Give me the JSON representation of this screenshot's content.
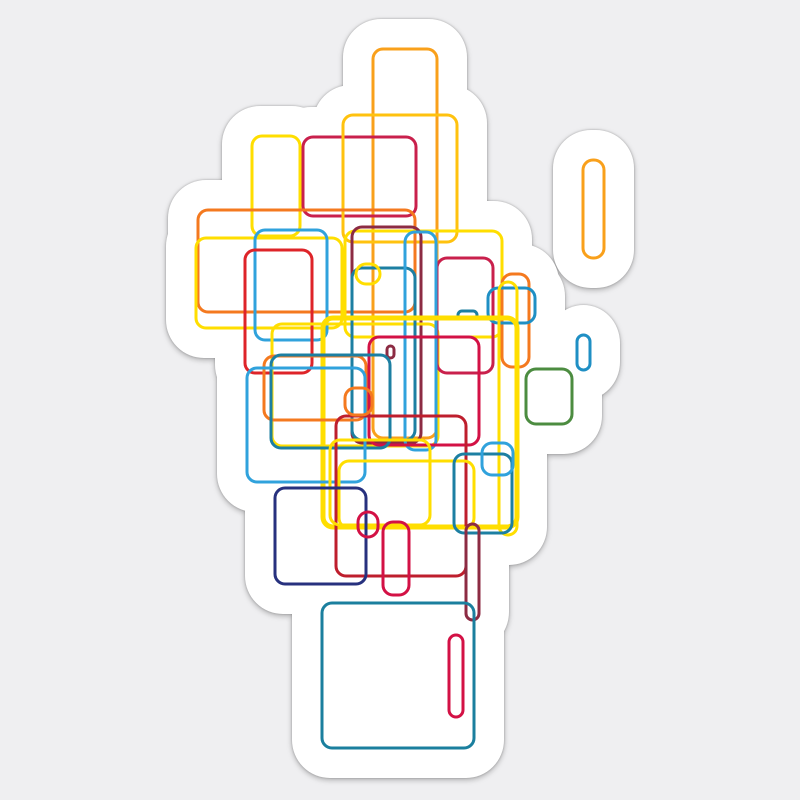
{
  "image": {
    "kind": "sticker-product-image",
    "description": "Die-cut white sticker with abstract generative artwork of overlapping rounded rectangle outlines on a light gray background"
  },
  "canvas": {
    "width": 800,
    "height": 800,
    "background_color": "#efeff1"
  },
  "sticker": {
    "fill": "#ffffff",
    "padding": 30,
    "lobe_corner_radius": 38,
    "shadow_filter": "drop-shadow(0px 2px 3px rgba(0,0,0,0.22)) drop-shadow(0px 0px 1px rgba(0,0,0,0.28))"
  },
  "artwork": {
    "default_stroke_width": 3,
    "default_corner_radius": 10,
    "palette": {
      "yellow": "#FFDE00",
      "gold": "#FFC20E",
      "amber": "#F9A01B",
      "orange": "#F4791F",
      "bright_red": "#DE2429",
      "crimson": "#C9204C",
      "pink_red": "#D31145",
      "brick": "#BE1E2D",
      "maroon": "#8C2B43",
      "sky_blue": "#30A2DC",
      "medium_blue": "#1F8FC4",
      "teal": "#1C7FA2",
      "dark_teal": "#1B7F9E",
      "navy": "#27317E",
      "green": "#4C8C40"
    },
    "rectangles": [
      {
        "x": 373,
        "y": 49,
        "w": 64,
        "h": 389,
        "color": "amber"
      },
      {
        "x": 252,
        "y": 136,
        "w": 48,
        "h": 100,
        "color": "yellow"
      },
      {
        "x": 303,
        "y": 137,
        "w": 113,
        "h": 79,
        "color": "crimson"
      },
      {
        "x": 343,
        "y": 115,
        "w": 114,
        "h": 127,
        "color": "gold"
      },
      {
        "x": 198,
        "y": 210,
        "w": 217,
        "h": 102,
        "color": "orange"
      },
      {
        "x": 345,
        "y": 231,
        "w": 157,
        "h": 106,
        "color": "yellow"
      },
      {
        "x": 196,
        "y": 238,
        "w": 146,
        "h": 90,
        "color": "yellow"
      },
      {
        "x": 352,
        "y": 227,
        "w": 69,
        "h": 216,
        "color": "maroon"
      },
      {
        "x": 255,
        "y": 230,
        "w": 72,
        "h": 110,
        "color": "sky_blue"
      },
      {
        "x": 245,
        "y": 250,
        "w": 67,
        "h": 123,
        "color": "bright_red"
      },
      {
        "x": 272,
        "y": 324,
        "w": 166,
        "h": 122,
        "color": "yellow"
      },
      {
        "x": 352,
        "y": 268,
        "w": 63,
        "h": 172,
        "color": "teal"
      },
      {
        "x": 437,
        "y": 258,
        "w": 56,
        "h": 115,
        "color": "crimson"
      },
      {
        "x": 405,
        "y": 232,
        "w": 31,
        "h": 218,
        "color": "sky_blue"
      },
      {
        "x": 502,
        "y": 274,
        "w": 27,
        "h": 93,
        "color": "orange"
      },
      {
        "x": 488,
        "y": 288,
        "w": 47,
        "h": 35,
        "color": "medium_blue"
      },
      {
        "x": 458,
        "y": 311,
        "w": 19,
        "h": 8,
        "color": "teal"
      },
      {
        "x": 583,
        "y": 160,
        "w": 21,
        "h": 98,
        "color": "amber"
      },
      {
        "x": 577,
        "y": 335,
        "w": 13,
        "h": 35,
        "color": "medium_blue"
      },
      {
        "x": 526,
        "y": 369,
        "w": 46,
        "h": 55,
        "color": "green"
      },
      {
        "x": 356,
        "y": 264,
        "w": 24,
        "h": 20,
        "color": "yellow"
      },
      {
        "x": 387,
        "y": 346,
        "w": 7,
        "h": 12,
        "color": "maroon"
      },
      {
        "x": 369,
        "y": 337,
        "w": 110,
        "h": 108,
        "color": "pink_red"
      },
      {
        "x": 323,
        "y": 318,
        "w": 194,
        "h": 209,
        "color": "yellow",
        "sw": 5
      },
      {
        "x": 264,
        "y": 356,
        "w": 102,
        "h": 64,
        "color": "orange"
      },
      {
        "x": 271,
        "y": 355,
        "w": 119,
        "h": 93,
        "color": "teal"
      },
      {
        "x": 247,
        "y": 368,
        "w": 118,
        "h": 114,
        "color": "sky_blue"
      },
      {
        "x": 336,
        "y": 416,
        "w": 130,
        "h": 160,
        "color": "brick"
      },
      {
        "x": 339,
        "y": 461,
        "w": 135,
        "h": 67,
        "color": "yellow"
      },
      {
        "x": 330,
        "y": 440,
        "w": 100,
        "h": 85,
        "color": "yellow"
      },
      {
        "x": 499,
        "y": 282,
        "w": 18,
        "h": 253,
        "color": "yellow"
      },
      {
        "x": 345,
        "y": 388,
        "w": 27,
        "h": 27,
        "color": "orange"
      },
      {
        "x": 454,
        "y": 454,
        "w": 58,
        "h": 79,
        "color": "teal"
      },
      {
        "x": 482,
        "y": 443,
        "w": 31,
        "h": 32,
        "color": "sky_blue"
      },
      {
        "x": 275,
        "y": 488,
        "w": 91,
        "h": 96,
        "color": "navy"
      },
      {
        "x": 358,
        "y": 512,
        "w": 20,
        "h": 25,
        "color": "pink_red"
      },
      {
        "x": 383,
        "y": 522,
        "w": 26,
        "h": 73,
        "color": "pink_red"
      },
      {
        "x": 466,
        "y": 524,
        "w": 13,
        "h": 96,
        "color": "maroon"
      },
      {
        "x": 322,
        "y": 603,
        "w": 152,
        "h": 145,
        "color": "dark_teal"
      },
      {
        "x": 449,
        "y": 635,
        "w": 14,
        "h": 82,
        "color": "pink_red"
      }
    ]
  }
}
